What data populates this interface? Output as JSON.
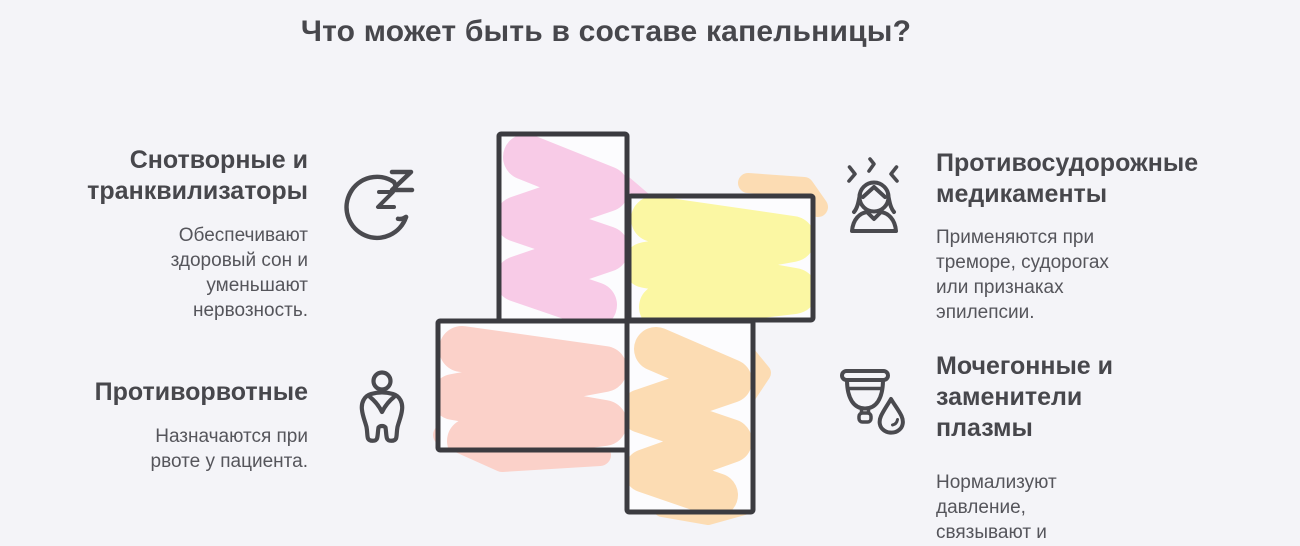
{
  "title": "Что может быть в составе капельницы?",
  "colors": {
    "background": "#f4f4f8",
    "outline": "#3b3b40",
    "icon": "#4a4a4f",
    "heading_text": "#47474c",
    "body_text": "#55555b",
    "rect_inner_white": "#fcfcfe"
  },
  "cross": {
    "blocks": [
      {
        "position": "top",
        "name": "pink-block",
        "color": "#f8cbe7"
      },
      {
        "position": "right",
        "name": "yellow-block",
        "color": "#fbf7a3"
      },
      {
        "position": "left",
        "name": "salmon-block",
        "color": "#fbd1c9"
      },
      {
        "position": "bottom",
        "name": "peach-block",
        "color": "#fcdcb3"
      }
    ]
  },
  "sections": [
    {
      "id": "sedatives",
      "icon": "moon-zzz-icon",
      "title": "Снотворные и транквилизаторы",
      "description": "Обеспечивают здоровый сон и уменьшают нервозность."
    },
    {
      "id": "anticonvulsants",
      "icon": "tremor-person-icon",
      "title": "Противосудорожные медикаменты",
      "description": "Применяются при треморе, судорогах или признаках эпилепсии."
    },
    {
      "id": "antiemetics",
      "icon": "nausea-person-icon",
      "title": "Противорвотные",
      "description": "Назначаются при рвоте у пациента."
    },
    {
      "id": "diuretics",
      "icon": "cup-drop-icon",
      "title": "Мочегонные и заменители плазмы",
      "description": "Нормализуют давление, связывают и выводят токсины."
    }
  ]
}
